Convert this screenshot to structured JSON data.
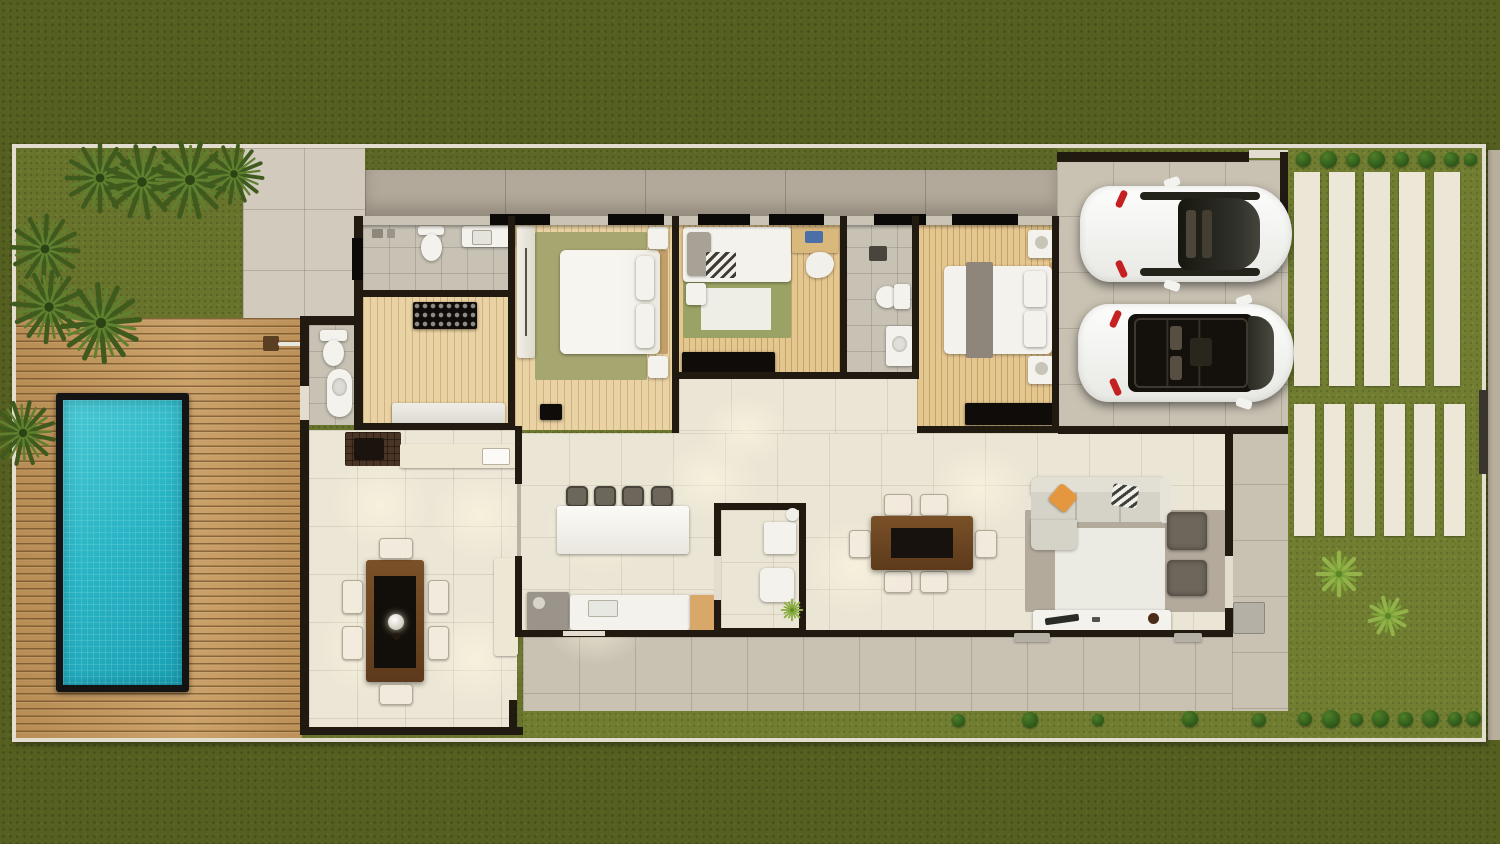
{
  "scene": {
    "type": "3d-floor-plan-top-view",
    "description": "Top-down 3D render of a single-storey house lot with swimming pool, timber deck, three bedrooms, two-car garage, gourmet terrace and landscaped driveway"
  },
  "palette": {
    "outer_grass": "#545f20",
    "inner_grass": "#68732c",
    "driveway_grass": "#717e31",
    "boundary_wall": "#e2ddcf",
    "pavement": "#d2cbbd",
    "rear_path": "#b2a99b",
    "deck_wood": "#c59a60",
    "pool_water": "#2ab6c6",
    "pool_frame": "#141414",
    "structure_wall": "#211a11",
    "interior_tile": "#ebe5d5",
    "bedroom_wood": "#e9d2a4",
    "rug_green": "#a6a671",
    "sofa_gray": "#d5d2c8",
    "accent_orange": "#e59740",
    "dining_table_wood": "#6b4522",
    "car_white": "#f5f5f3",
    "car_accent_red": "#c42222",
    "paving_slab": "#ebe6d5"
  },
  "areas": {
    "pool": "Swimming pool",
    "deck": "Timber pool deck",
    "garden": "Front garden with palm shrubs",
    "entry_court": "Paved entry court",
    "rear_path": "Rear paved path",
    "bath1": "Bathroom 1",
    "closet": "Walk-in closet",
    "bed1": "Bedroom 1 (master)",
    "bed2": "Bedroom 2",
    "bath2": "Bathroom 2",
    "bed3": "Bedroom 3",
    "hall": "Hallway",
    "kitchen": "Kitchen with island",
    "powder": "Powder room / laundry",
    "dining": "Dining area",
    "living": "Living room",
    "terrace": "Gourmet terrace with barbecue",
    "pool_bath": "Pool bathroom",
    "garage": "Double carport",
    "driveway": "Slab-paved driveway garden",
    "sidewalk": "Street sidewalk"
  },
  "vehicles": {
    "car1": "White car, closed roof, parked facing left",
    "car2": "White car with open sunroof, parked facing left"
  },
  "counts": {
    "palm_shrubs": 8,
    "driveway_slabs_front": 5,
    "driveway_slabs_rear": 6,
    "hedge_bushes_top": 8,
    "hedge_bushes_bottom": 8,
    "star_plants": 3,
    "cars": 2,
    "bar_stools": 4,
    "dining_chairs": 6,
    "terrace_chairs": 6,
    "living_ottomans": 2,
    "bedrooms": 3,
    "bathrooms": 4
  }
}
